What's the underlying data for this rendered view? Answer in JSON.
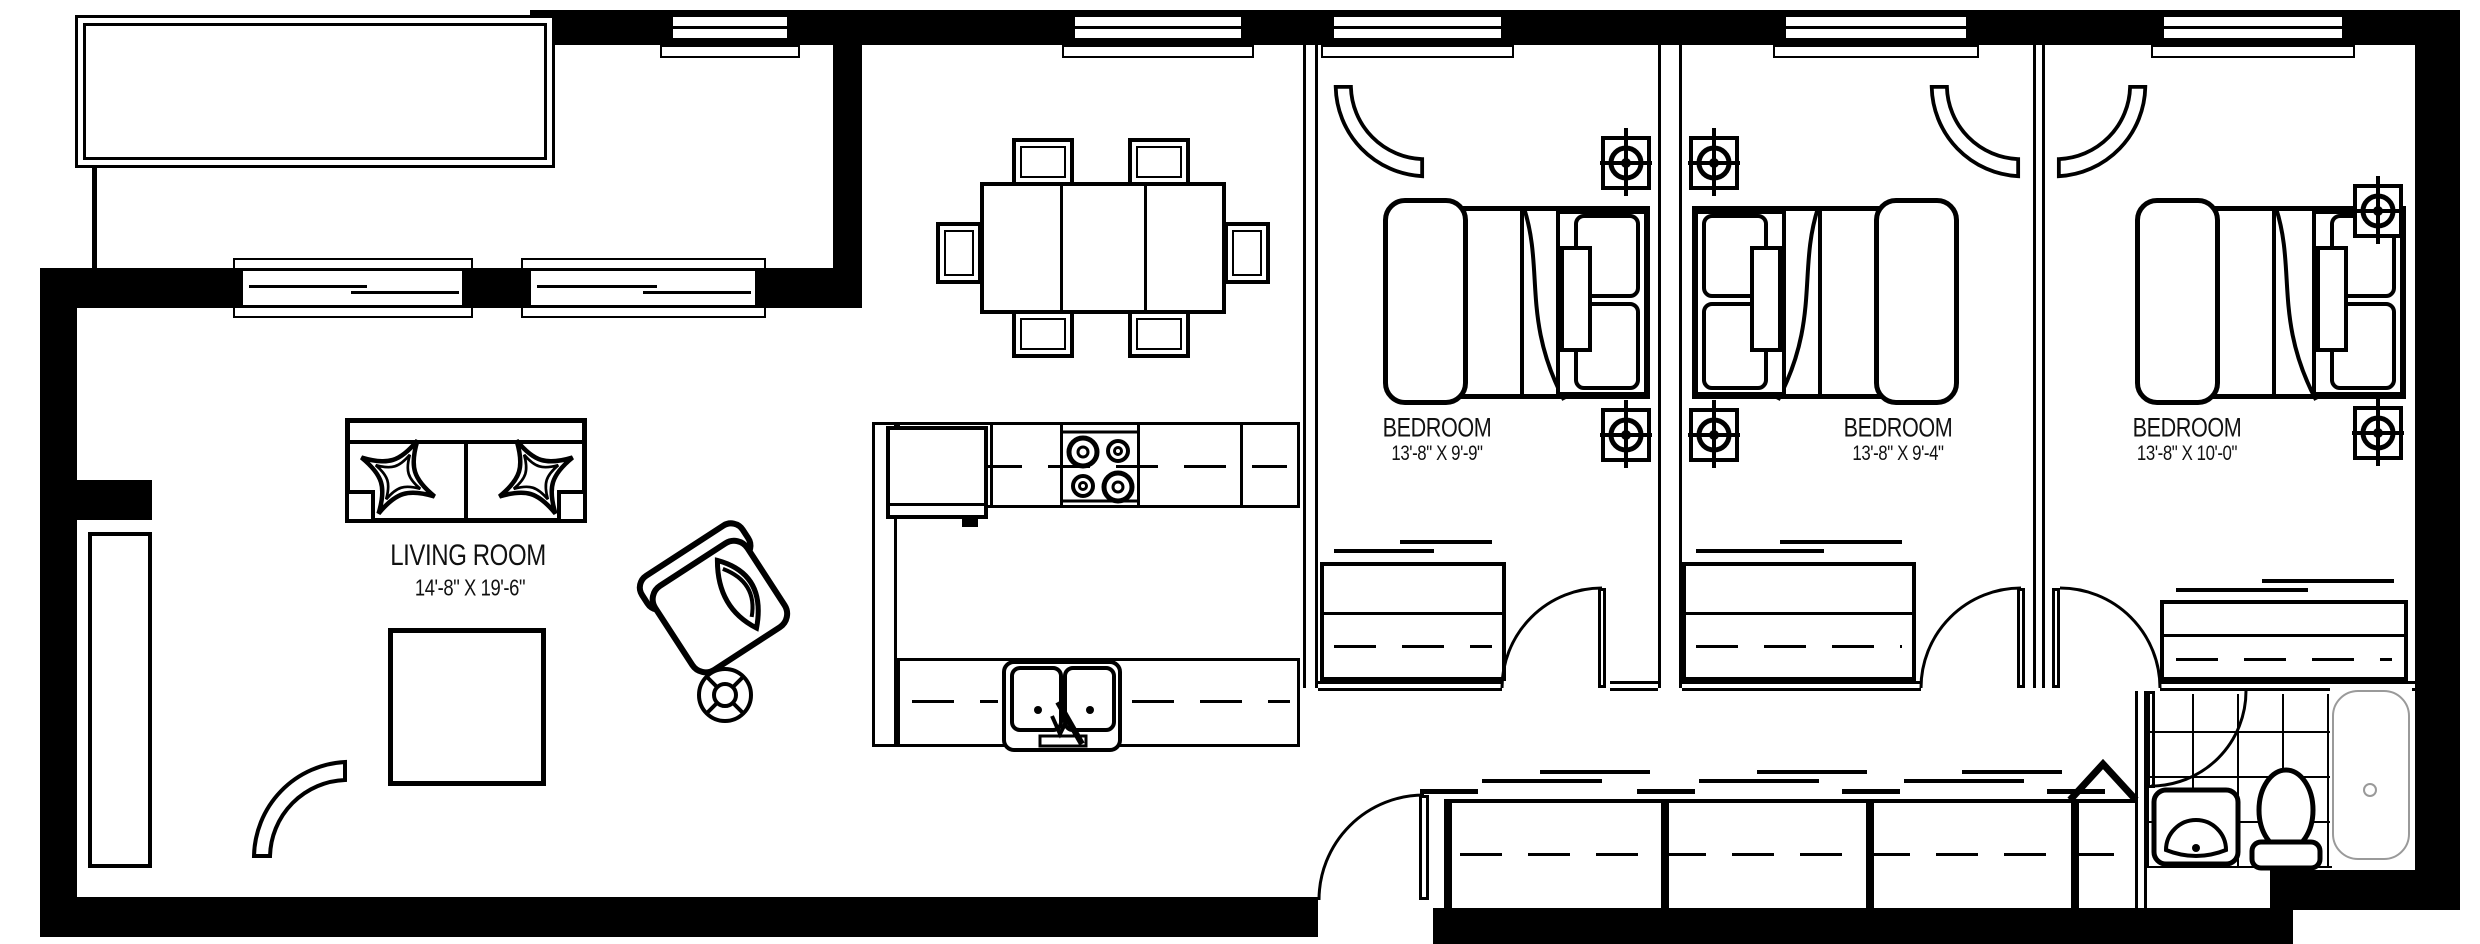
{
  "rooms": {
    "living": {
      "label": "LIVING ROOM",
      "dims": "14'-8\" X 19'-6\""
    },
    "bedroom1": {
      "label": "BEDROOM",
      "dims": "13'-8\" X 9'-9\""
    },
    "bedroom2": {
      "label": "BEDROOM",
      "dims": "13'-8\" X 9'-4\""
    },
    "bedroom3": {
      "label": "BEDROOM",
      "dims": "13'-8\" X 10'-0\""
    }
  },
  "colors": {
    "walls": "#000000",
    "background": "#ffffff",
    "tub_outline": "#9a9a9a"
  }
}
